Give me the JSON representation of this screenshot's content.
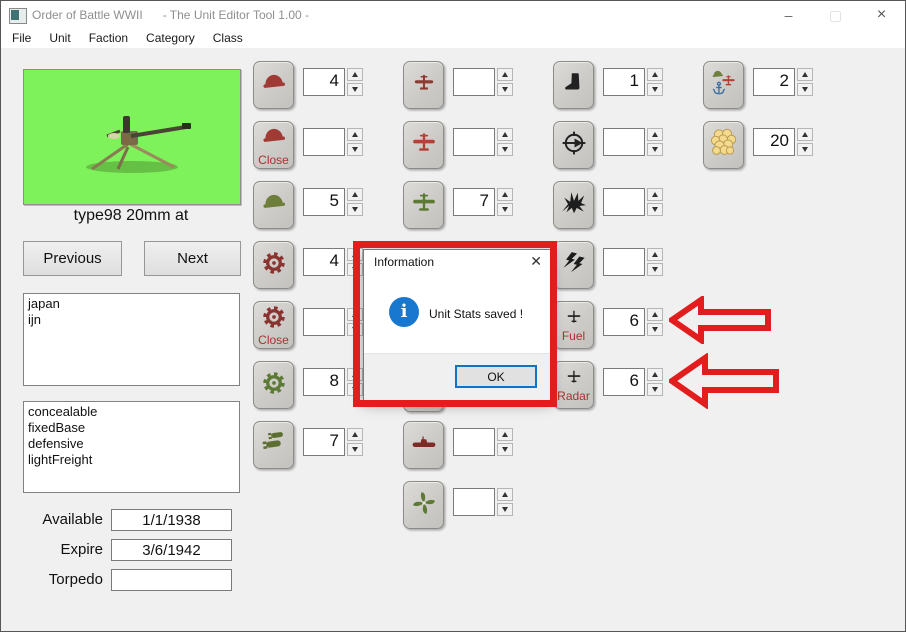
{
  "window": {
    "title": "Order of Battle WWII      - The Unit Editor Tool 1.00 -",
    "controls": {
      "minimize": "–",
      "maximize": "▢",
      "close": "×"
    }
  },
  "menu": {
    "items": [
      "File",
      "Unit",
      "Faction",
      "Category",
      "Class"
    ]
  },
  "unit": {
    "name": "type98 20mm at",
    "previous_label": "Previous",
    "next_label": "Next",
    "factions_text": "japan\nijn",
    "traits_text": "concealable\nfixedBase\ndefensive\nlightFreight",
    "fields": [
      {
        "label": "Available",
        "value": "1/1/1938"
      },
      {
        "label": "Expire",
        "value": "3/6/1942"
      },
      {
        "label": "Torpedo",
        "value": ""
      }
    ]
  },
  "stats": {
    "columns": [
      {
        "rows": [
          {
            "slot": 0,
            "icon": "helmet-red",
            "value": "4"
          },
          {
            "slot": 1,
            "icon": "helmet-red",
            "label": "Close",
            "value": ""
          },
          {
            "slot": 2,
            "icon": "helmet-green",
            "value": "5"
          },
          {
            "slot": 3,
            "icon": "gear-red",
            "value": "4"
          },
          {
            "slot": 4,
            "icon": "gear-red",
            "label": "Close",
            "value": ""
          },
          {
            "slot": 5,
            "icon": "gear-green",
            "value": "8"
          },
          {
            "slot": 6,
            "icon": "bombs-green",
            "value": "7"
          }
        ]
      },
      {
        "rows": [
          {
            "slot": 0,
            "icon": "plane-red",
            "value": ""
          },
          {
            "slot": 1,
            "icon": "plane-red2",
            "value": ""
          },
          {
            "slot": 2,
            "icon": "plane-green",
            "value": "7"
          },
          {
            "slot": 6,
            "icon": "submarine-red",
            "value": ""
          },
          {
            "slot": 7,
            "icon": "propeller-green",
            "value": ""
          }
        ]
      },
      {
        "rows": [
          {
            "slot": 0,
            "icon": "boot-black",
            "value": "1"
          },
          {
            "slot": 1,
            "icon": "scope-black",
            "value": ""
          },
          {
            "slot": 2,
            "icon": "explosion-black",
            "value": ""
          },
          {
            "slot": 3,
            "icon": "lightning-black",
            "value": ""
          },
          {
            "slot": 4,
            "icon": "plane-small",
            "label": "Fuel",
            "value": "6"
          },
          {
            "slot": 5,
            "icon": "plane-small",
            "label": "Radar",
            "value": "6"
          }
        ]
      },
      {
        "rows": [
          {
            "slot": 0,
            "icon": "transport-combo",
            "value": "2"
          },
          {
            "slot": 1,
            "icon": "coins-gold",
            "value": "20"
          }
        ]
      }
    ]
  },
  "dialog": {
    "title": "Information",
    "message": "Unit Stats saved !",
    "ok_label": "OK",
    "close_glyph": "✕",
    "info_glyph": "i"
  },
  "annotations": {
    "highlight_color": "#e21d1d",
    "arrow_targets": [
      "fuel-spinner",
      "radar-spinner"
    ]
  }
}
